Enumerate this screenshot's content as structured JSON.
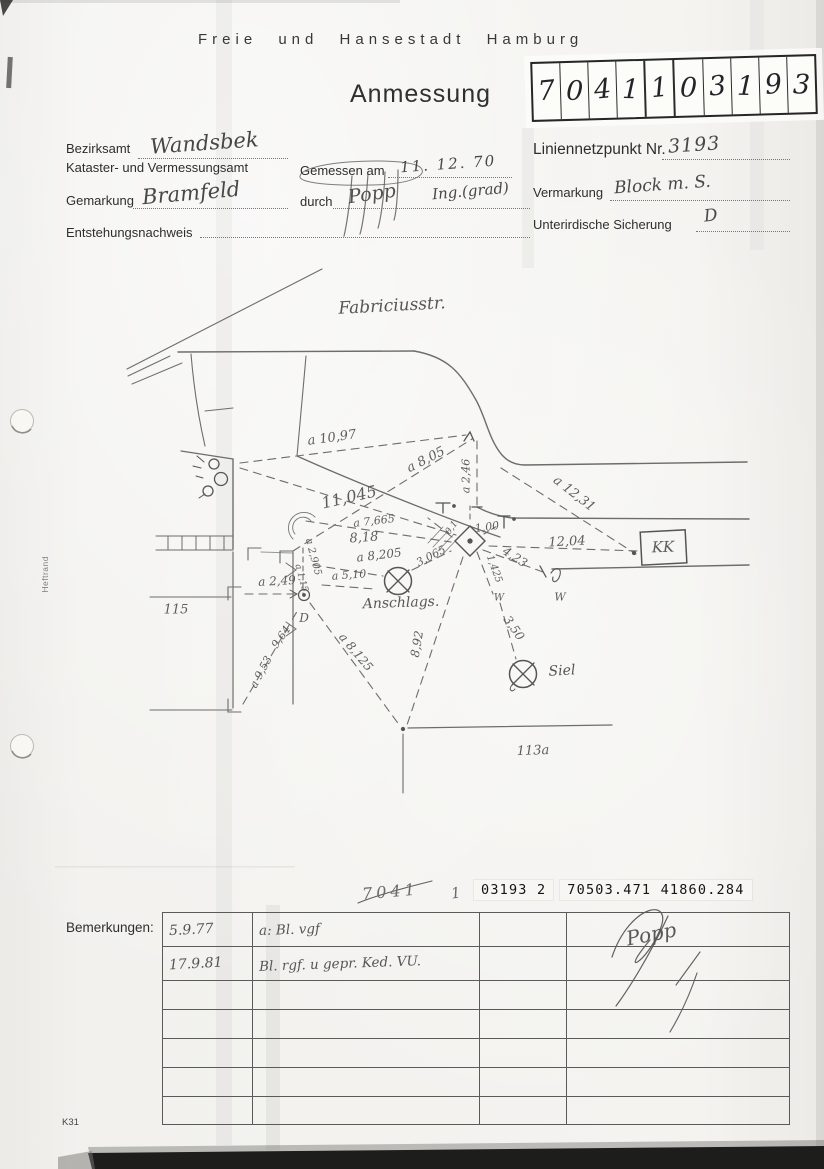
{
  "header": {
    "city": "Freie und Hansestadt Hamburg",
    "title": "Anmessung"
  },
  "stamp": {
    "digits": [
      "7",
      "0",
      "4",
      "1",
      "1",
      "0",
      "3",
      "1",
      "9",
      "3"
    ]
  },
  "form": {
    "bezirksamt_label": "Bezirksamt",
    "bezirksamt_value": "Wandsbek",
    "kataster_label": "Kataster- und Vermessungsamt",
    "gemessen_label": "Gemessen am",
    "gemessen_value": "11. 12. 70",
    "gemarkung_label": "Gemarkung",
    "gemarkung_value": "Bramfeld",
    "durch_label": "durch",
    "durch_value": "Popp",
    "durch_value2": "Ing.(grad)",
    "entstehung_label": "Entstehungsnachweis",
    "liniennetz_label": "Liniennetzpunkt Nr.",
    "liniennetz_value": "3193",
    "vermarkung_label": "Vermarkung",
    "vermarkung_value": "Block m. S.",
    "sicherung_label": "Unterirdische Sicherung",
    "sicherung_value": "D"
  },
  "sketch": {
    "street_name": "Fabriciusstr.",
    "labels": [
      {
        "t": "Fabriciusstr.",
        "x": 392,
        "y": 306,
        "r": -3,
        "s": 17,
        "c": "big"
      },
      {
        "t": "a 10,97",
        "x": 332,
        "y": 438,
        "r": -8,
        "s": 13
      },
      {
        "t": "a 8,05",
        "x": 426,
        "y": 460,
        "r": -27,
        "s": 13
      },
      {
        "t": "a 2,46",
        "x": 466,
        "y": 476,
        "r": -90,
        "s": 11
      },
      {
        "t": "11,045",
        "x": 349,
        "y": 497,
        "r": -13,
        "s": 16
      },
      {
        "t": "a 7,665",
        "x": 374,
        "y": 521,
        "r": -7,
        "s": 11
      },
      {
        "t": "8,18",
        "x": 364,
        "y": 538,
        "r": -4,
        "s": 13
      },
      {
        "t": "a 8,205",
        "x": 379,
        "y": 555,
        "r": -7,
        "s": 12
      },
      {
        "t": "a 5,10",
        "x": 349,
        "y": 575,
        "r": -4,
        "s": 11
      },
      {
        "t": "3,065",
        "x": 431,
        "y": 556,
        "r": -28,
        "s": 11
      },
      {
        "t": "a 2,905",
        "x": 313,
        "y": 557,
        "r": 75,
        "s": 10
      },
      {
        "t": "a 1,15",
        "x": 301,
        "y": 578,
        "r": 75,
        "s": 9
      },
      {
        "t": "a 12,31",
        "x": 574,
        "y": 494,
        "r": 38,
        "s": 13
      },
      {
        "t": "12,04",
        "x": 567,
        "y": 542,
        "r": -3,
        "s": 13
      },
      {
        "t": "4,23",
        "x": 515,
        "y": 557,
        "r": 33,
        "s": 12
      },
      {
        "t": "1,425",
        "x": 494,
        "y": 569,
        "r": 70,
        "s": 10
      },
      {
        "t": "W",
        "x": 499,
        "y": 598,
        "r": 0,
        "s": 10
      },
      {
        "t": "W",
        "x": 560,
        "y": 597,
        "r": 0,
        "s": 11
      },
      {
        "t": "3,50",
        "x": 514,
        "y": 628,
        "r": 55,
        "s": 12
      },
      {
        "t": "Siel",
        "x": 562,
        "y": 671,
        "r": -3,
        "s": 14,
        "c": "big"
      },
      {
        "t": "8,92",
        "x": 417,
        "y": 644,
        "r": -80,
        "s": 12
      },
      {
        "t": "a 8,125",
        "x": 356,
        "y": 652,
        "r": 50,
        "s": 12
      },
      {
        "t": "a 9,53",
        "x": 261,
        "y": 672,
        "r": -62,
        "s": 11
      },
      {
        "t": "9,64",
        "x": 281,
        "y": 637,
        "r": -55,
        "s": 11
      },
      {
        "t": "a 2,49",
        "x": 277,
        "y": 581,
        "r": -3,
        "s": 12
      },
      {
        "t": "Anschlags.",
        "x": 401,
        "y": 603,
        "r": -2,
        "s": 14,
        "c": "big"
      },
      {
        "t": "D",
        "x": 304,
        "y": 618,
        "r": 0,
        "s": 12
      },
      {
        "t": "115",
        "x": 176,
        "y": 610,
        "r": 0,
        "s": 13
      },
      {
        "t": "113a",
        "x": 533,
        "y": 751,
        "r": -2,
        "s": 13
      },
      {
        "t": "KK",
        "x": 663,
        "y": 547,
        "r": -2,
        "s": 15
      },
      {
        "t": "1,00",
        "x": 487,
        "y": 527,
        "r": -8,
        "s": 11
      },
      {
        "t": "0,1",
        "x": 452,
        "y": 528,
        "r": -55,
        "s": 9
      }
    ]
  },
  "reference": {
    "handwritten": "7041",
    "handwritten2": "1",
    "typed1": "03193 2",
    "typed2": "70503.471  41860.284"
  },
  "remarks": {
    "label": "Bemerkungen:",
    "rows": [
      {
        "date": "5.9.77",
        "text": "a: Bl. vgf",
        "sig": "Popp"
      },
      {
        "date": "17.9.81",
        "text": "Bl. rgf. u gepr. Ked. VU.",
        "sig": ""
      }
    ]
  },
  "side": {
    "margin_label": "Heftrand"
  },
  "footer": {
    "form_code": "K31"
  },
  "colors": {
    "pencil": "#5d5d5d",
    "ink": "#474747",
    "print": "#2e2e2e"
  }
}
